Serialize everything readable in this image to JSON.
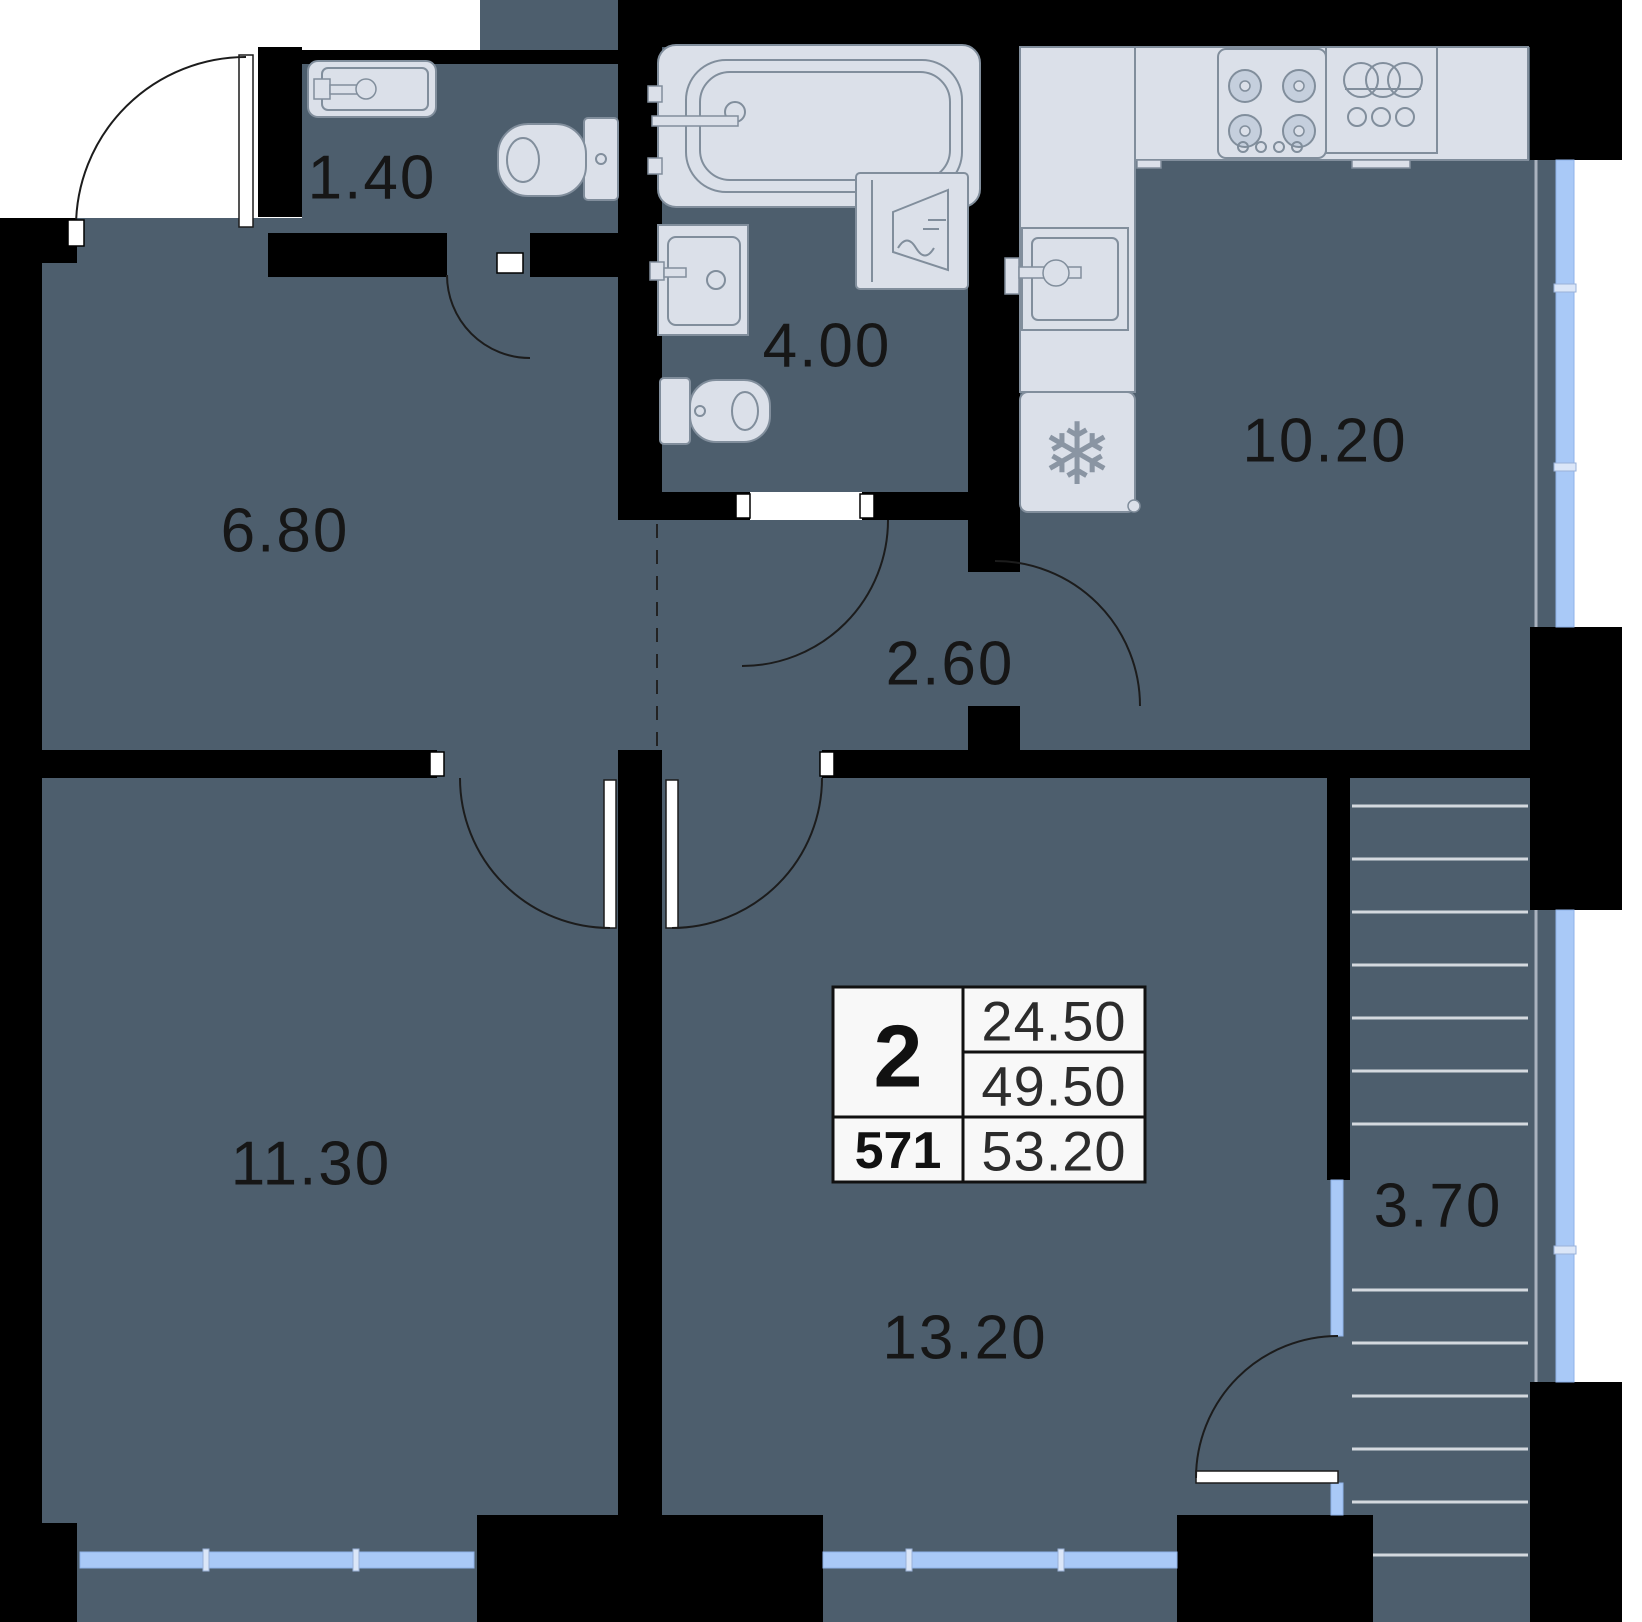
{
  "plan_title": "2-room apartment floor plan",
  "info_box": {
    "rooms_count": "2",
    "unit_number": "571",
    "living_area": "24.50",
    "area_without_balcony": "49.50",
    "total_area": "53.20"
  },
  "room_areas": {
    "wc_small": "1.40",
    "bathroom": "4.00",
    "hall": "6.80",
    "corridor": "2.60",
    "kitchen": "10.20",
    "bedroom": "11.30",
    "living_room": "13.20",
    "stairs_balcony": "3.70"
  },
  "icons": {
    "fridge_snowflake": "❄"
  },
  "colors": {
    "floor": "#4d5e6d",
    "wall": "#000000",
    "fixture_fill": "#dbe0e9",
    "fixture_stroke": "#818e9c",
    "window_blue": "#a9c9f7"
  }
}
